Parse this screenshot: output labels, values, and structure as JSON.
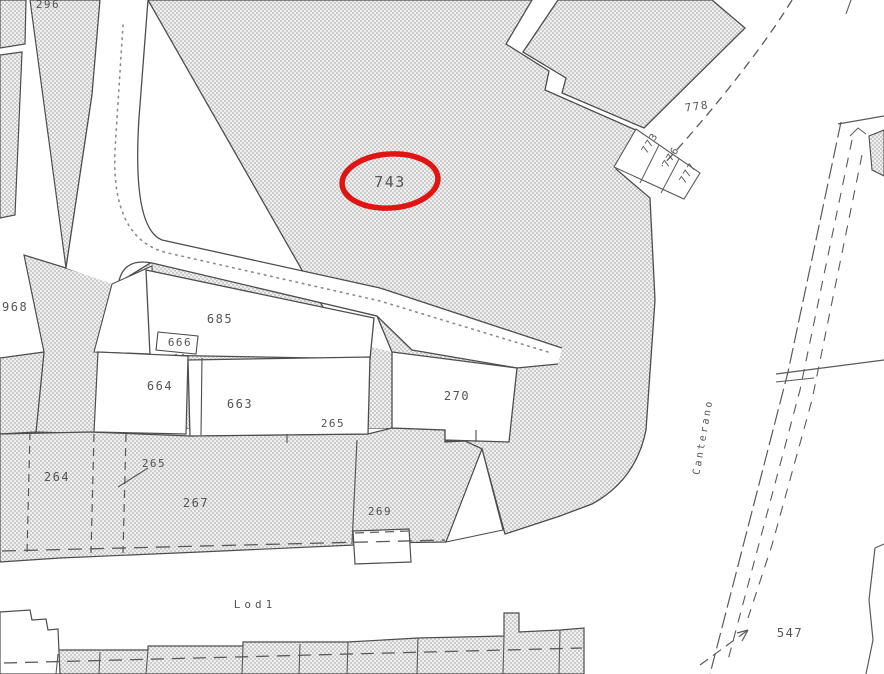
{
  "map": {
    "colors": {
      "background": "#ffffff",
      "parcel_fill_base": "#efefef",
      "parcel_fill_dot": "#cdcdcd",
      "line": "#4d4d4d",
      "highlight": "#e11414",
      "label": "#555555"
    },
    "highlight": {
      "parcel": "743"
    },
    "parcel_labels": {
      "p296": {
        "text": "296"
      },
      "p743": {
        "text": "743"
      },
      "p778": {
        "text": "778"
      },
      "p773": {
        "text": "773"
      },
      "p776": {
        "text": "776"
      },
      "p777": {
        "text": "777"
      },
      "p968": {
        "text": "968"
      },
      "p685": {
        "text": "685"
      },
      "p666": {
        "text": "666"
      },
      "p664": {
        "text": "664"
      },
      "p663": {
        "text": "663"
      },
      "p265_inline": {
        "text": "265"
      },
      "p270": {
        "text": "270"
      },
      "p264": {
        "text": "264"
      },
      "p265": {
        "text": "265"
      },
      "p267": {
        "text": "267"
      },
      "p269": {
        "text": "269"
      },
      "p547": {
        "text": "547"
      }
    },
    "street_labels": {
      "lodi": {
        "text": "Lod1"
      },
      "canterano": {
        "text": "Canterano"
      }
    }
  }
}
